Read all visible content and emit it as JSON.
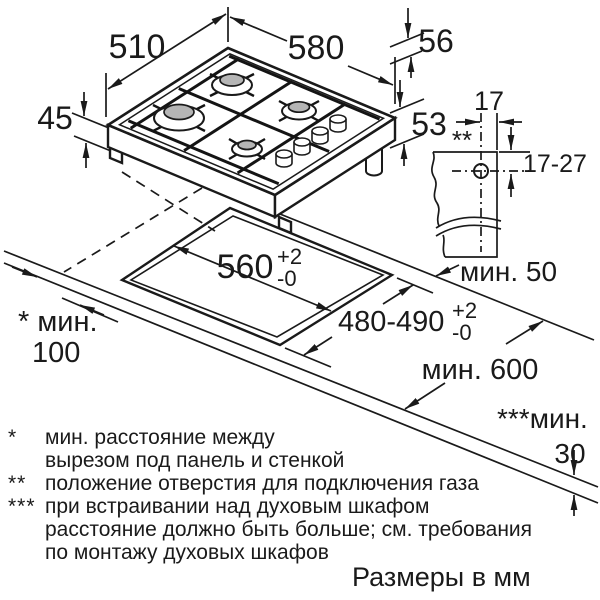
{
  "drawing": {
    "units_note": "Размеры в мм",
    "colors": {
      "line": "#1a1a1a",
      "burner_cap": "#b5b5b5",
      "background": "#ffffff"
    },
    "dims": {
      "depth": "510",
      "width": "580",
      "height_front": "45",
      "height_total": "56",
      "height_gas": "53",
      "gas_offset": "17",
      "gas_range": "17-27",
      "gas_marker": "**",
      "cutout_width": "560",
      "cutout_depth": "480-490",
      "tol_plus": "+2",
      "tol_minus": "-0",
      "min_rear": "мин. 50",
      "min_side_label": "* мин.",
      "min_side_value": "100",
      "min_worktop_depth": "мин. 600",
      "min_below_label": "***мин.",
      "min_below_value": "30"
    },
    "footnotes": [
      {
        "marker": "*",
        "lines": [
          "мин. расстояние между",
          "вырезом под панель и стенкой"
        ]
      },
      {
        "marker": "**",
        "lines": [
          "положение отверстия для подключения газа"
        ]
      },
      {
        "marker": "***",
        "lines": [
          "при встраивании над духовым шкафом",
          "расстояние должно быть больше; см. требования",
          "по монтажу духовых шкафов"
        ]
      }
    ]
  }
}
